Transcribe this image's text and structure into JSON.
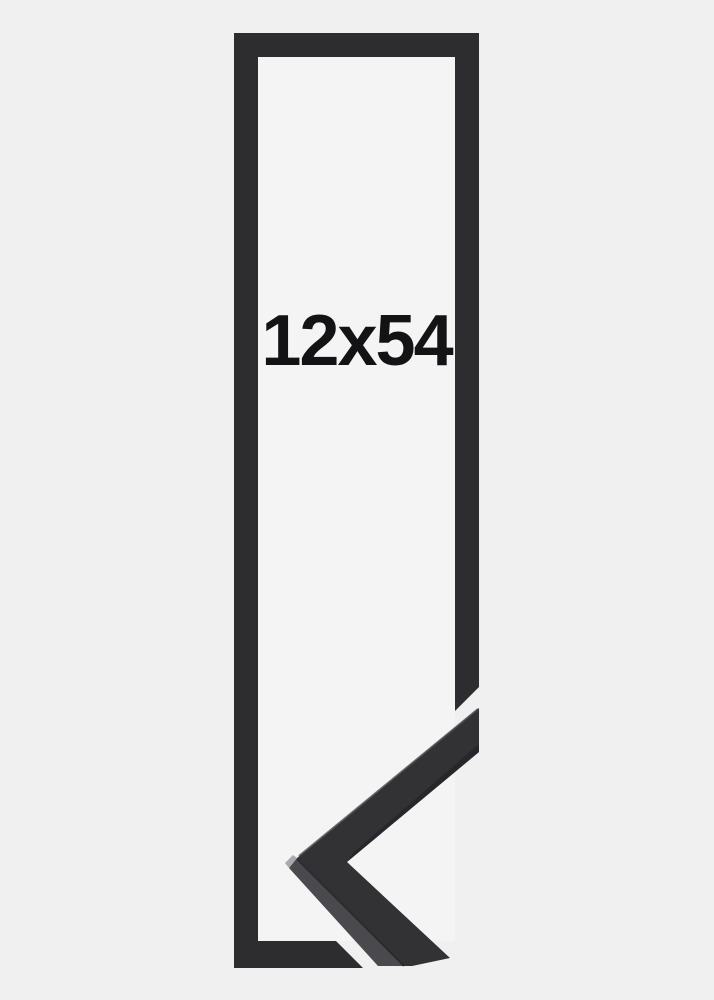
{
  "product": {
    "size_label": "12x54"
  },
  "colors": {
    "page_bg": "#f0f0f1",
    "opening_bg": "#f4f4f5",
    "frame": "#2d2d30",
    "sample_face": "#323235",
    "sample_bevel": "#4a4a4e",
    "sample_edge_shadow": "#1f1f22",
    "sample_top_sheen": "#4b4b4f",
    "sample_corner_highlight": "#aaaaad",
    "label_text": "#131315"
  }
}
